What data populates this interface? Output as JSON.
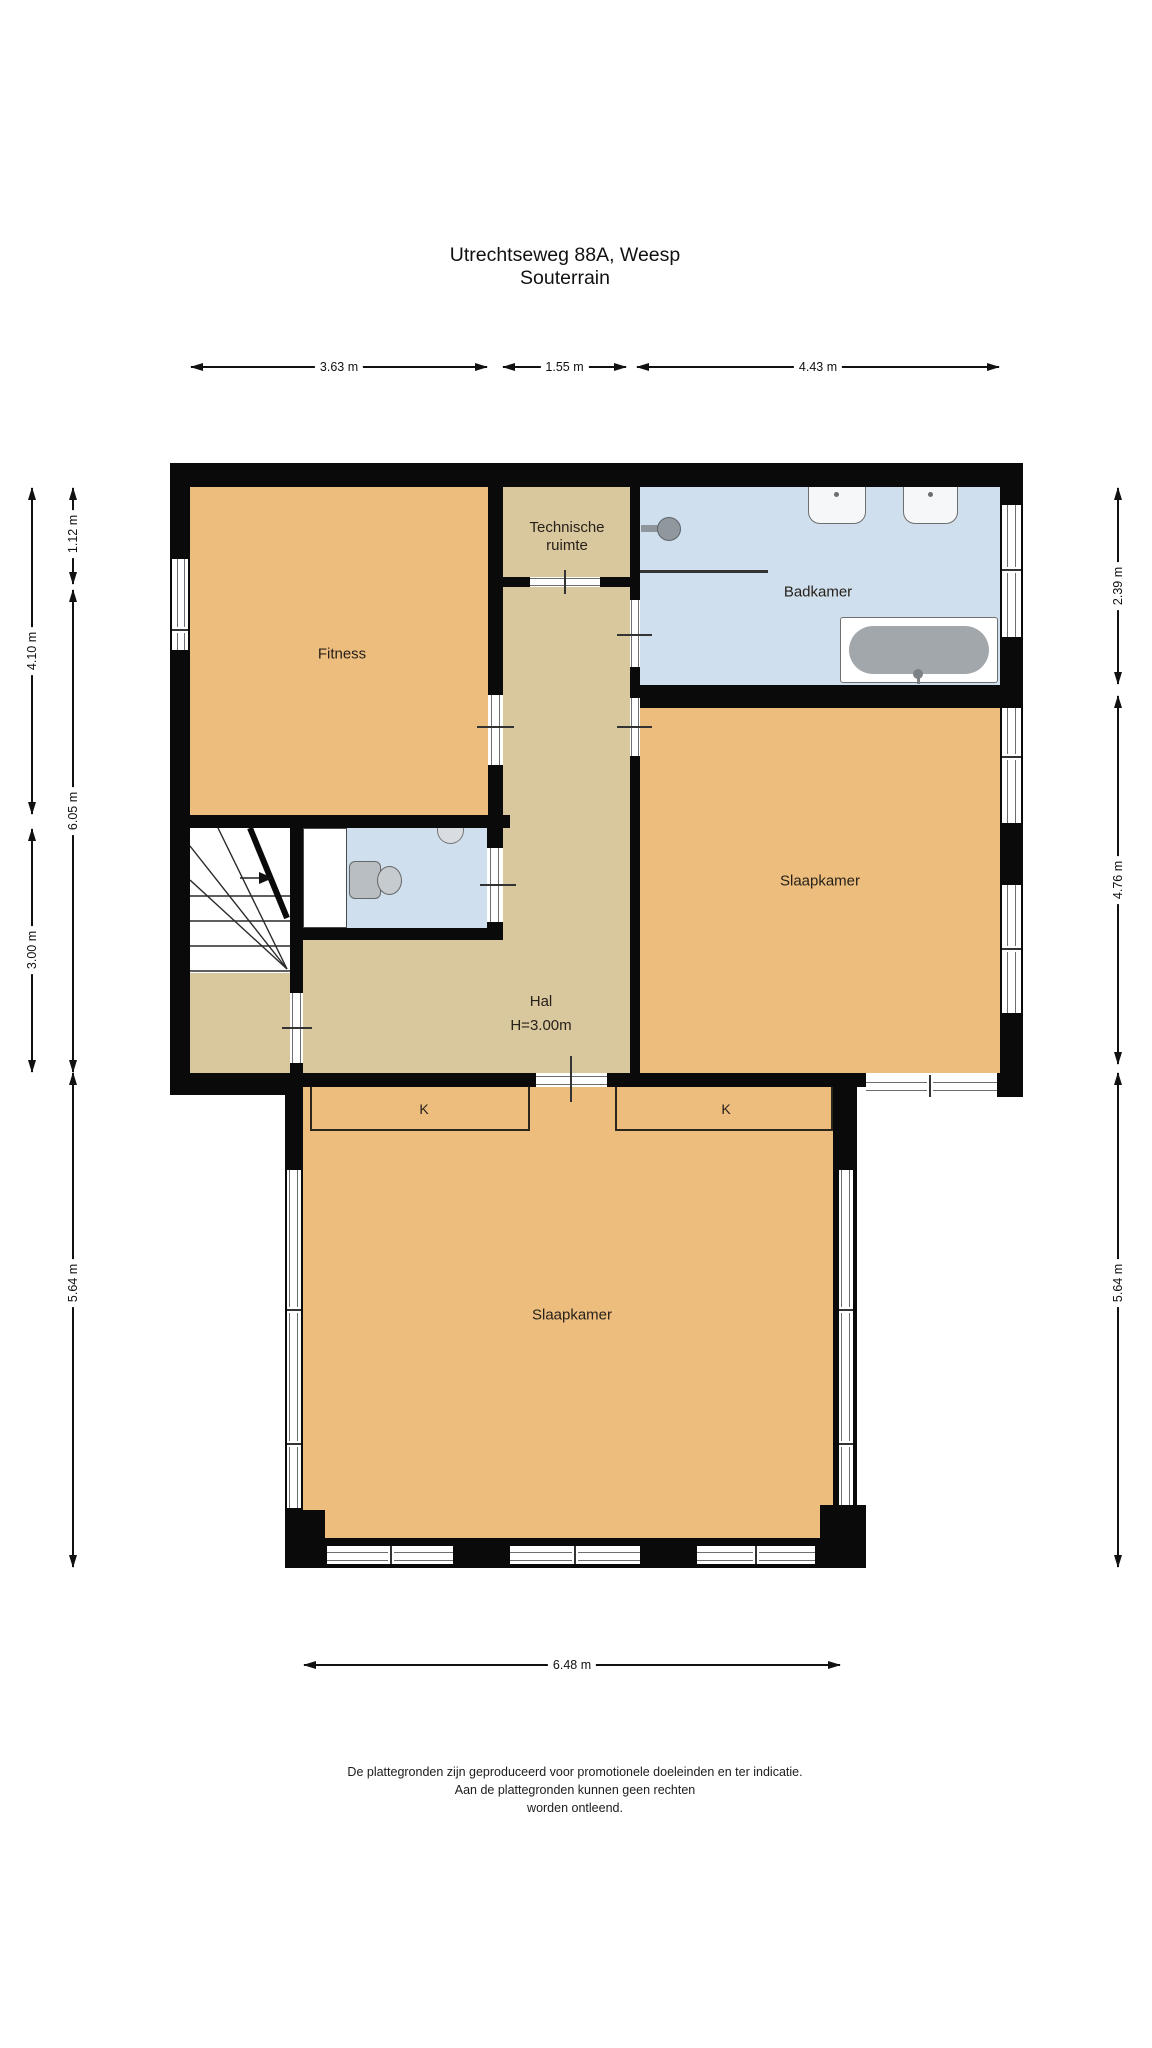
{
  "title": {
    "line1": "Utrechtseweg 88A, Weesp",
    "line2": "Souterrain"
  },
  "rooms": {
    "fitness": {
      "label": "Fitness"
    },
    "technische_ruimte": {
      "line1": "Technische",
      "line2": "ruimte"
    },
    "badkamer": {
      "label": "Badkamer"
    },
    "slaapkamer_boven": {
      "label": "Slaapkamer"
    },
    "hal": {
      "label": "Hal",
      "ceiling_height": "H=3.00m"
    },
    "kast_links": {
      "label": "K"
    },
    "kast_rechts": {
      "label": "K"
    },
    "slaapkamer_beneden": {
      "label": "Slaapkamer"
    }
  },
  "dimensions": {
    "top": [
      {
        "value": "3.63 m"
      },
      {
        "value": "1.55 m"
      },
      {
        "value": "4.43 m"
      }
    ],
    "left_outer": [
      {
        "value": "4.10 m"
      },
      {
        "value": "3.00 m"
      }
    ],
    "left_inner": [
      {
        "value": "1.12 m"
      },
      {
        "value": "6.05 m"
      },
      {
        "value": "5.64 m"
      }
    ],
    "right": [
      {
        "value": "2.39 m"
      },
      {
        "value": "4.76 m"
      },
      {
        "value": "5.64 m"
      }
    ],
    "bottom": [
      {
        "value": "6.48 m"
      }
    ]
  },
  "disclaimer": {
    "line1": "De plattegronden zijn geproduceerd voor promotionele doeleinden en ter indicatie.",
    "line2": "Aan de plattegronden kunnen geen rechten",
    "line3": "worden ontleend."
  },
  "colors": {
    "room_orange": "#edbd7e",
    "room_tan": "#d9c79e",
    "room_blue": "#cfdfed",
    "wall": "#0a0a0a"
  }
}
